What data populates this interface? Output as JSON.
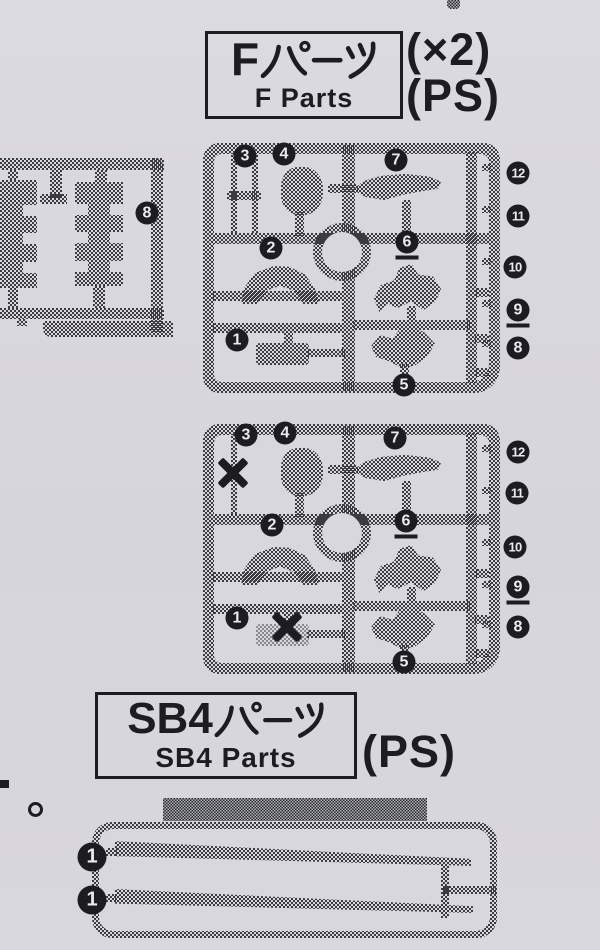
{
  "page": {
    "background": "#d8d7dd",
    "ink": "#1d1d21"
  },
  "f_section": {
    "title_latin": "F",
    "title_kana": "パーツ",
    "title_en": "F Parts",
    "qty_label": "(×2)",
    "material_label": "(PS)",
    "runner1": {
      "callouts": [
        {
          "n": "3",
          "x": 245,
          "y": 156
        },
        {
          "n": "4",
          "x": 284,
          "y": 154
        },
        {
          "n": "7",
          "x": 396,
          "y": 160
        },
        {
          "n": "12",
          "x": 518,
          "y": 173
        },
        {
          "n": "11",
          "x": 518,
          "y": 216
        },
        {
          "n": "2",
          "x": 271,
          "y": 248
        },
        {
          "n": "6",
          "x": 407,
          "y": 242,
          "u": true
        },
        {
          "n": "10",
          "x": 515,
          "y": 267
        },
        {
          "n": "9",
          "x": 518,
          "y": 310,
          "u": true
        },
        {
          "n": "8",
          "x": 518,
          "y": 348
        },
        {
          "n": "1",
          "x": 237,
          "y": 340
        },
        {
          "n": "5",
          "x": 404,
          "y": 385
        }
      ]
    },
    "runner2": {
      "callouts": [
        {
          "n": "3",
          "x": 246,
          "y": 435
        },
        {
          "n": "4",
          "x": 285,
          "y": 433
        },
        {
          "n": "7",
          "x": 395,
          "y": 438
        },
        {
          "n": "12",
          "x": 518,
          "y": 452
        },
        {
          "n": "11",
          "x": 517,
          "y": 493
        },
        {
          "n": "2",
          "x": 272,
          "y": 525
        },
        {
          "n": "6",
          "x": 406,
          "y": 521,
          "u": true
        },
        {
          "n": "10",
          "x": 515,
          "y": 547
        },
        {
          "n": "9",
          "x": 518,
          "y": 587,
          "u": true
        },
        {
          "n": "8",
          "x": 518,
          "y": 627
        },
        {
          "n": "1",
          "x": 237,
          "y": 618
        },
        {
          "n": "5",
          "x": 404,
          "y": 662
        }
      ],
      "crosses": [
        {
          "x": 233,
          "y": 473
        },
        {
          "x": 287,
          "y": 627
        }
      ]
    }
  },
  "left_runner": {
    "callouts": [
      {
        "n": "8",
        "x": 147,
        "y": 213
      }
    ]
  },
  "sb4_section": {
    "title_latin": "SB4",
    "title_kana": "パーツ",
    "title_en": "SB4 Parts",
    "material_label": "(PS)",
    "runner": {
      "callouts": [
        {
          "n": "1",
          "x": 92,
          "y": 857,
          "big": true
        },
        {
          "n": "1",
          "x": 92,
          "y": 900,
          "big": true
        }
      ]
    }
  },
  "marginalia": {
    "period_mark": "。"
  }
}
